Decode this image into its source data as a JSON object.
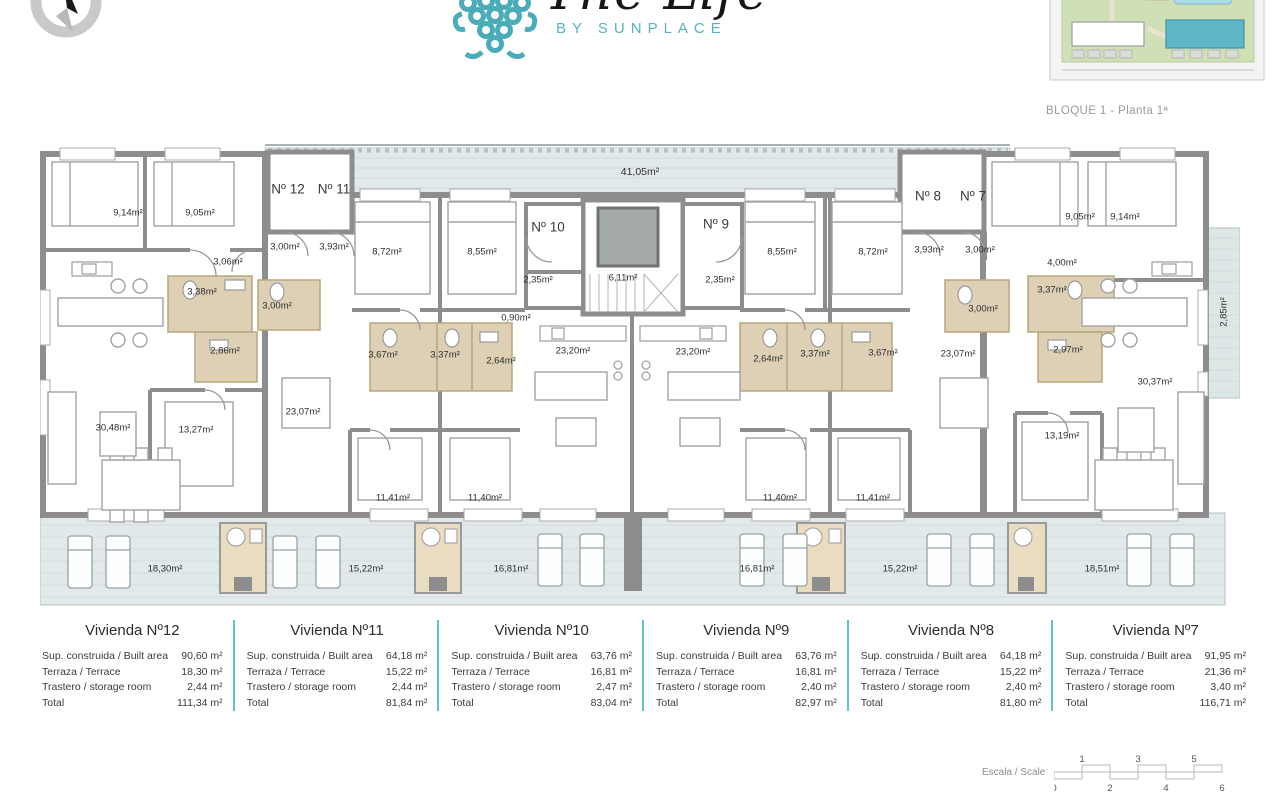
{
  "header": {
    "logo_text": "The Life",
    "logo_subtext": "BY SUNPLACE",
    "caption": "BLOQUE 1 - Planta 1ª"
  },
  "colors": {
    "teal": "#55b4c0",
    "wall": "#8d8d8d",
    "terrace_fill": "#e2e9eb",
    "bath_fill": "#ddd0b5",
    "storage_fill": "#eadcc0"
  },
  "plan": {
    "labels": [
      {
        "t": "Nº 12",
        "x": 248,
        "y": 49,
        "c": "unit"
      },
      {
        "t": "Nº 11",
        "x": 294,
        "y": 49,
        "c": "unit"
      },
      {
        "t": "Nº 10",
        "x": 508,
        "y": 87,
        "c": "unit"
      },
      {
        "t": "Nº 9",
        "x": 676,
        "y": 84,
        "c": "unit"
      },
      {
        "t": "Nº 8",
        "x": 888,
        "y": 56,
        "c": "unit"
      },
      {
        "t": "Nº 7",
        "x": 933,
        "y": 56,
        "c": "unit"
      },
      {
        "t": "41,05m²",
        "x": 600,
        "y": 32,
        "c": "big"
      },
      {
        "t": "9,14m²",
        "x": 88,
        "y": 73
      },
      {
        "t": "9,05m²",
        "x": 160,
        "y": 73
      },
      {
        "t": "3,06m²",
        "x": 188,
        "y": 122
      },
      {
        "t": "3,00m²",
        "x": 245,
        "y": 107
      },
      {
        "t": "3,93m²",
        "x": 294,
        "y": 107
      },
      {
        "t": "3,38m²",
        "x": 162,
        "y": 152
      },
      {
        "t": "3,00m²",
        "x": 237,
        "y": 166
      },
      {
        "t": "2,86m²",
        "x": 185,
        "y": 211
      },
      {
        "t": "30,48m²",
        "x": 73,
        "y": 288
      },
      {
        "t": "13,27m²",
        "x": 156,
        "y": 290
      },
      {
        "t": "23,07m²",
        "x": 263,
        "y": 272
      },
      {
        "t": "8,72m²",
        "x": 347,
        "y": 112
      },
      {
        "t": "8,55m²",
        "x": 442,
        "y": 112
      },
      {
        "t": "2,35m²",
        "x": 498,
        "y": 140
      },
      {
        "t": "6,11m²",
        "x": 583,
        "y": 138
      },
      {
        "t": "0,90m²",
        "x": 476,
        "y": 178
      },
      {
        "t": "3,67m²",
        "x": 343,
        "y": 215
      },
      {
        "t": "3,37m²",
        "x": 405,
        "y": 215
      },
      {
        "t": "2,64m²",
        "x": 461,
        "y": 221
      },
      {
        "t": "23,20m²",
        "x": 533,
        "y": 211
      },
      {
        "t": "23,20m²",
        "x": 653,
        "y": 212
      },
      {
        "t": "2,35m²",
        "x": 680,
        "y": 140
      },
      {
        "t": "2,64m²",
        "x": 728,
        "y": 219
      },
      {
        "t": "3,37m²",
        "x": 775,
        "y": 214
      },
      {
        "t": "3,67m²",
        "x": 843,
        "y": 213
      },
      {
        "t": "8,55m²",
        "x": 742,
        "y": 112
      },
      {
        "t": "8,72m²",
        "x": 833,
        "y": 112
      },
      {
        "t": "3,93m²",
        "x": 889,
        "y": 110
      },
      {
        "t": "3,00m²",
        "x": 940,
        "y": 110
      },
      {
        "t": "4,00m²",
        "x": 1022,
        "y": 123
      },
      {
        "t": "9,05m²",
        "x": 1040,
        "y": 77
      },
      {
        "t": "9,14m²",
        "x": 1085,
        "y": 77
      },
      {
        "t": "3,37m²",
        "x": 1012,
        "y": 150
      },
      {
        "t": "3,00m²",
        "x": 943,
        "y": 169
      },
      {
        "t": "23,07m²",
        "x": 918,
        "y": 214
      },
      {
        "t": "2,97m²",
        "x": 1028,
        "y": 210
      },
      {
        "t": "30,37m²",
        "x": 1115,
        "y": 242
      },
      {
        "t": "13,19m²",
        "x": 1022,
        "y": 296
      },
      {
        "t": "11,41m²",
        "x": 353,
        "y": 358
      },
      {
        "t": "11,40m²",
        "x": 445,
        "y": 358
      },
      {
        "t": "11,40m²",
        "x": 740,
        "y": 358
      },
      {
        "t": "11,41m²",
        "x": 833,
        "y": 358
      },
      {
        "t": "18,30m²",
        "x": 125,
        "y": 429
      },
      {
        "t": "15,22m²",
        "x": 326,
        "y": 429
      },
      {
        "t": "16,81m²",
        "x": 471,
        "y": 429
      },
      {
        "t": "16,81m²",
        "x": 717,
        "y": 429
      },
      {
        "t": "15,22m²",
        "x": 860,
        "y": 429
      },
      {
        "t": "18,51m²",
        "x": 1062,
        "y": 429
      },
      {
        "t": "2,85m²",
        "x": 1184,
        "y": 172,
        "c": "rot"
      }
    ]
  },
  "tables": {
    "row_labels": [
      "Sup. construida / Built area",
      "Terraza / Terrace",
      "Trastero / storage room",
      "Total"
    ],
    "units": [
      {
        "title": "Vivienda Nº12",
        "values": [
          "90,60 m²",
          "18,30 m²",
          "2,44 m²",
          "111,34 m²"
        ]
      },
      {
        "title": "Vivienda Nº11",
        "values": [
          "64,18 m²",
          "15,22 m²",
          "2,44 m²",
          "81,84 m²"
        ]
      },
      {
        "title": "Vivienda Nº10",
        "values": [
          "63,76 m²",
          "16,81 m²",
          "2,47 m²",
          "83,04 m²"
        ]
      },
      {
        "title": "Vivienda Nº9",
        "values": [
          "63,76 m²",
          "16,81 m²",
          "2,40 m²",
          "82,97 m²"
        ]
      },
      {
        "title": "Vivienda Nº8",
        "values": [
          "64,18 m²",
          "15,22 m²",
          "2,40 m²",
          "81,80 m²"
        ]
      },
      {
        "title": "Vivienda Nº7",
        "values": [
          "91,95 m²",
          "21,36 m²",
          "3,40 m²",
          "116,71 m²"
        ]
      }
    ]
  },
  "scale": {
    "label": "Escala / Scale",
    "numbers_above": [
      "1",
      "3",
      "5"
    ],
    "numbers_below": [
      "0",
      "2",
      "4",
      "6"
    ]
  }
}
